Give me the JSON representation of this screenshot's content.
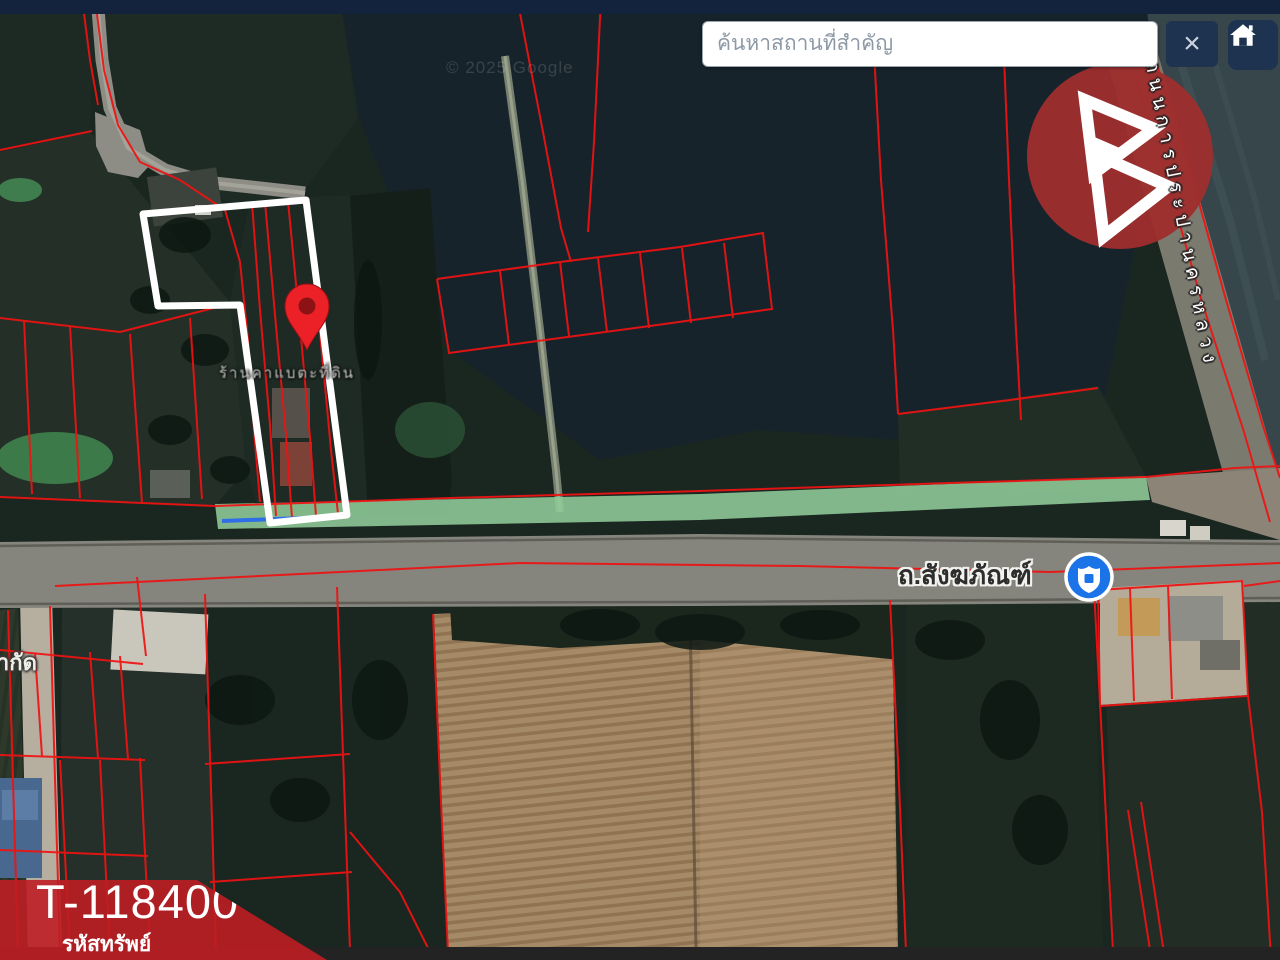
{
  "topbar": {
    "search_placeholder": "ค้นหาสถานที่สำคัญ",
    "close_label": "×"
  },
  "map": {
    "road_label": "ถ.สังฆภัณฑ์",
    "side_road_label": "ถนนการประปานครหลวง",
    "place_label": "ร้านคาแบตะที่ดิน",
    "partial_label": "จำกัด",
    "watermark": "© 2025 Google"
  },
  "badge": {
    "code": "T-118400",
    "caption": "รหัสทรัพย์"
  },
  "colors": {
    "topbar": "#13233d",
    "button": "#1d3350",
    "parcel_red": "#f01212",
    "boundary_white": "#ffffff",
    "badge_red": "rgba(190,30,36,0.9)",
    "pin_red": "#ec2127",
    "logo_red": "#9e2e2e",
    "strip_green": "#90cc98",
    "sign_blue": "#1b73e8",
    "road_gray": "#85857d"
  }
}
